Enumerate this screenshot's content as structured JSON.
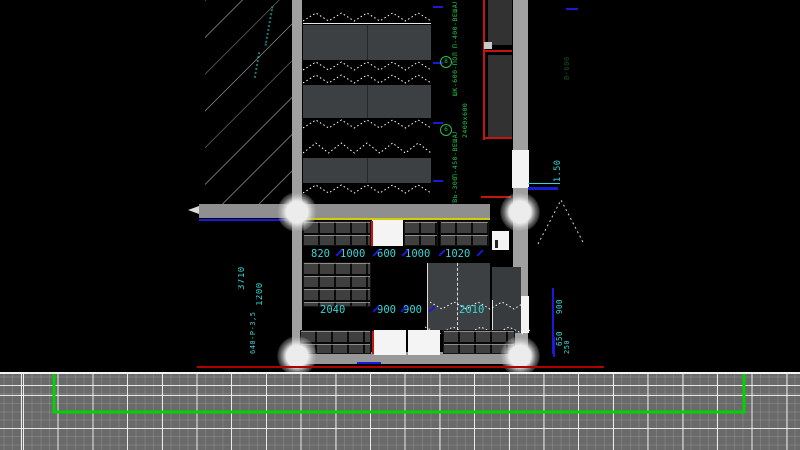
{
  "drawing": {
    "upper_dims": [
      "820",
      "1000",
      "600",
      "1000",
      "1020"
    ],
    "lower_dims": [
      "2040",
      "900",
      "900",
      "2010"
    ],
    "left_dims": {
      "total": "3710",
      "depth": "1200",
      "note": "640-Р-3,5"
    },
    "door_width": "1.50",
    "right_dims": {
      "upper": "900",
      "lower": "650"
    },
    "green_labels": [
      "П-400-ВЕШАЛО",
      "ШК-600-ПОЛКА",
      "2400х600",
      "П-450-ВЕШАЛО",
      "ОБУВЬ-300"
    ],
    "green_badges": [
      "8",
      "6"
    ],
    "side_label": "В-600",
    "corner_label": "250"
  },
  "colors": {
    "wall": "#a0a0a0",
    "furniture_dark": "#3d4043",
    "cabinet": "#3f3f3f",
    "dim_cyan": "#39d4d4",
    "text_green": "#25c04a",
    "accent_red": "#c41414",
    "accent_blue": "#1a1ad8",
    "accent_yellow": "#d0d000",
    "grid_bg": "#6a6a6a",
    "route_green": "#00d400",
    "opening_white": "#f4f4f4"
  }
}
